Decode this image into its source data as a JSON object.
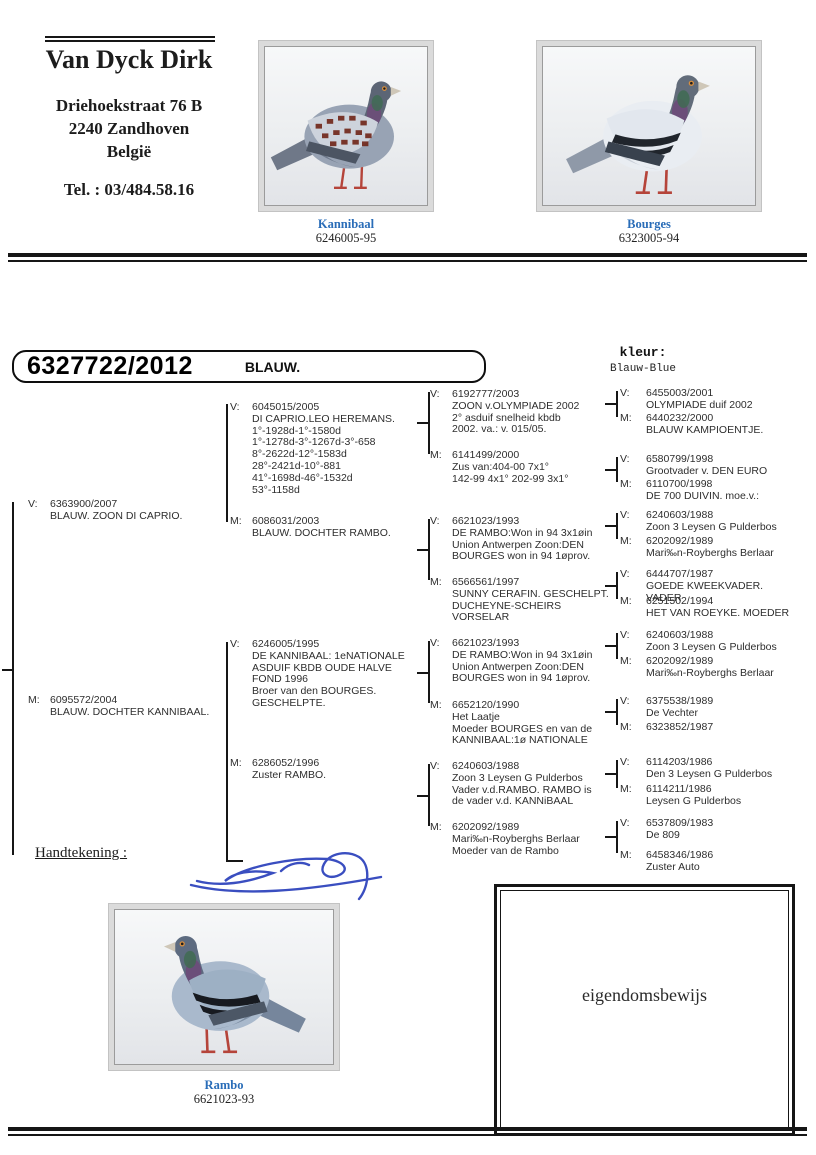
{
  "header": {
    "name": "Van Dyck Dirk",
    "address_line1": "Driehoekstraat 76 B",
    "address_line2": "2240 Zandhoven",
    "address_line3": "België",
    "phone": "Tel. : 03/484.58.16"
  },
  "photos": {
    "top_left": {
      "name": "Kannibaal",
      "ring": "6246005-95"
    },
    "top_right": {
      "name": "Bourges",
      "ring": "6323005-94"
    },
    "bottom": {
      "name": "Rambo",
      "ring": "6621023-93"
    }
  },
  "subject": {
    "ring": "6327722/2012",
    "color": "BLAUW.",
    "kleur_label": "kleur:",
    "kleur_value": "Blauw-Blue"
  },
  "signature": {
    "label": "Handtekening :"
  },
  "ownership": {
    "label": "eigendomsbewijs"
  },
  "colors": {
    "caption_blue": "#2a6db8",
    "signature_blue": "#3a4ec0"
  },
  "pedigree": {
    "gen1": [
      {
        "sex": "V:",
        "code": "6363900/2007",
        "desc": "BLAUW. ZOON DI CAPRIO."
      },
      {
        "sex": "M:",
        "code": "6095572/2004",
        "desc": "BLAUW. DOCHTER KANNIBAAL."
      }
    ],
    "gen2": [
      {
        "sex": "V:",
        "code": "6045015/2005",
        "desc": "DI CAPRIO.LEO HEREMANS.\n1°-1928d-1°-1580d\n1°-1278d-3°-1267d-3°-658\n8°-2622d-12°-1583d\n28°-2421d-10°-881\n41°-1698d-46°-1532d\n53°-1158d"
      },
      {
        "sex": "M:",
        "code": "6086031/2003",
        "desc": "BLAUW. DOCHTER RAMBO."
      },
      {
        "sex": "V:",
        "code": "6246005/1995",
        "desc": "DE KANNIBAAL: 1eNATIONALE\nASDUIF KBDB OUDE HALVE\nFOND 1996\nBroer van den BOURGES.\nGESCHELPTE."
      },
      {
        "sex": "M:",
        "code": "6286052/1996",
        "desc": "Zuster RAMBO."
      }
    ],
    "gen3": [
      {
        "sex": "V:",
        "code": "6192777/2003",
        "desc": "ZOON v.OLYMPIADE 2002\n2° asduif snelheid kbdb\n2002. va.: v. 015/05."
      },
      {
        "sex": "M:",
        "code": "6141499/2000",
        "desc": "Zus van:404-00 7x1°\n142-99 4x1° 202-99 3x1°"
      },
      {
        "sex": "V:",
        "code": "6621023/1993",
        "desc": "DE RAMBO:Won in 94 3x1øin\nUnion Antwerpen Zoon:DEN\nBOURGES won in 94 1øprov."
      },
      {
        "sex": "M:",
        "code": "6566561/1997",
        "desc": "SUNNY CERAFIN. GESCHELPT.\nDUCHEYNE-SCHEIRS VORSELAR"
      },
      {
        "sex": "V:",
        "code": "6621023/1993",
        "desc": "DE RAMBO:Won in 94 3x1øin\nUnion Antwerpen Zoon:DEN\nBOURGES won in 94 1øprov."
      },
      {
        "sex": "M:",
        "code": "6652120/1990",
        "desc": "Het Laatje\nMoeder BOURGES en van de\nKANNIBAAL:1ø NATIONALE"
      },
      {
        "sex": "V:",
        "code": "6240603/1988",
        "desc": "Zoon 3 Leysen G Pulderbos\nVader v.d.RAMBO. RAMBO is\nde vader v.d. KANNiBAAL"
      },
      {
        "sex": "M:",
        "code": "6202092/1989",
        "desc": "Mari‰n-Royberghs Berlaar\nMoeder van de Rambo"
      }
    ],
    "gen4": [
      {
        "sex": "V:",
        "code": "6455003/2001",
        "desc": "OLYMPIADE duif 2002"
      },
      {
        "sex": "M:",
        "code": "6440232/2000",
        "desc": "BLAUW KAMPIOENTJE."
      },
      {
        "sex": "V:",
        "code": "6580799/1998",
        "desc": "Grootvader v. DEN EURO"
      },
      {
        "sex": "M:",
        "code": "6110700/1998",
        "desc": "DE 700 DUIVIN. moe.v.:"
      },
      {
        "sex": "V:",
        "code": "6240603/1988",
        "desc": "Zoon 3 Leysen G Pulderbos"
      },
      {
        "sex": "M:",
        "code": "6202092/1989",
        "desc": "Mari‰n-Royberghs Berlaar"
      },
      {
        "sex": "V:",
        "code": "6444707/1987",
        "desc": "GOEDE KWEEKVADER. VADER"
      },
      {
        "sex": "M:",
        "code": "6251502/1994",
        "desc": "HET VAN ROEYKE. MOEDER"
      },
      {
        "sex": "V:",
        "code": "6240603/1988",
        "desc": "Zoon 3 Leysen G Pulderbos"
      },
      {
        "sex": "M:",
        "code": "6202092/1989",
        "desc": "Mari‰n-Royberghs Berlaar"
      },
      {
        "sex": "V:",
        "code": "6375538/1989",
        "desc": "De Vechter"
      },
      {
        "sex": "M:",
        "code": "6323852/1987",
        "desc": ""
      },
      {
        "sex": "V:",
        "code": "6114203/1986",
        "desc": "Den 3 Leysen G Pulderbos"
      },
      {
        "sex": "M:",
        "code": "6114211/1986",
        "desc": "Leysen G Pulderbos"
      },
      {
        "sex": "V:",
        "code": "6537809/1983",
        "desc": "De 809"
      },
      {
        "sex": "M:",
        "code": "6458346/1986",
        "desc": "Zuster Auto"
      }
    ]
  }
}
